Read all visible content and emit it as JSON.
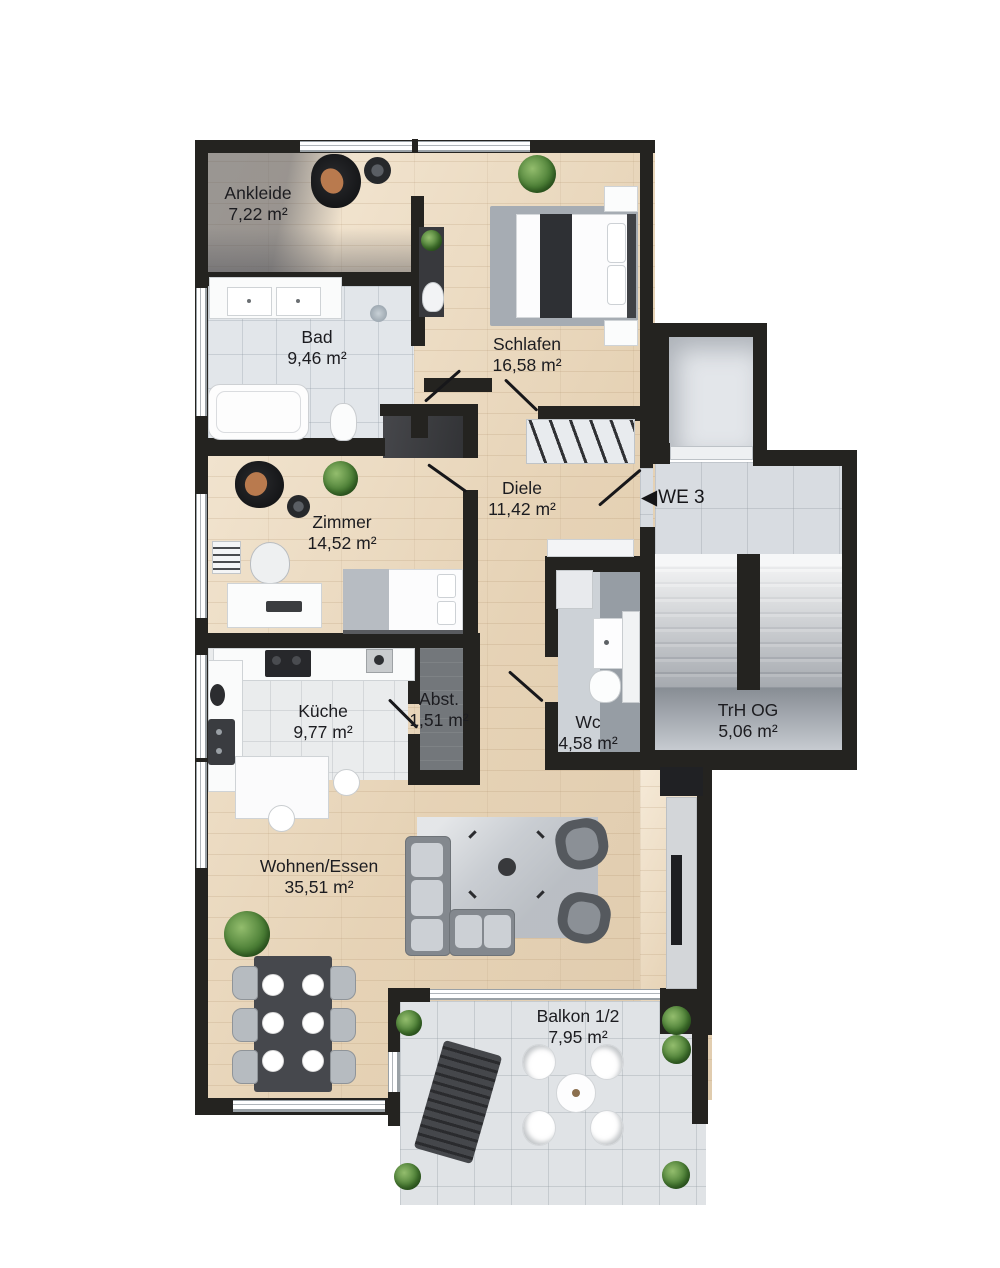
{
  "plan": {
    "entrance": {
      "arrow": "◀",
      "label": "WE 3"
    },
    "rooms": [
      {
        "key": "ankleide",
        "name": "Ankleide",
        "area": "7,22 m²"
      },
      {
        "key": "bad",
        "name": "Bad",
        "area": "9,46 m²"
      },
      {
        "key": "schlafen",
        "name": "Schlafen",
        "area": "16,58 m²"
      },
      {
        "key": "zimmer",
        "name": "Zimmer",
        "area": "14,52 m²"
      },
      {
        "key": "diele",
        "name": "Diele",
        "area": "11,42 m²"
      },
      {
        "key": "kueche",
        "name": "Küche",
        "area": "9,77 m²"
      },
      {
        "key": "abstellraum",
        "name": "Abst.",
        "area": "1,51 m²"
      },
      {
        "key": "wc",
        "name": "Wc",
        "area": "4,58 m²"
      },
      {
        "key": "treppenhaus",
        "name": "TrH OG",
        "area": "5,06 m²"
      },
      {
        "key": "wohnen_essen",
        "name": "Wohnen/Essen",
        "area": "35,51 m²"
      },
      {
        "key": "balkon",
        "name": "Balkon 1/2",
        "area": "7,95 m²"
      }
    ],
    "colors": {
      "wall": "#242320",
      "wood_floor": "#ead9c0",
      "bath_tile": "#e2e6ea",
      "stair_tile": "#d8dce1",
      "balcony_tile": "#e0e3e6",
      "text": "#1c1c20"
    }
  }
}
